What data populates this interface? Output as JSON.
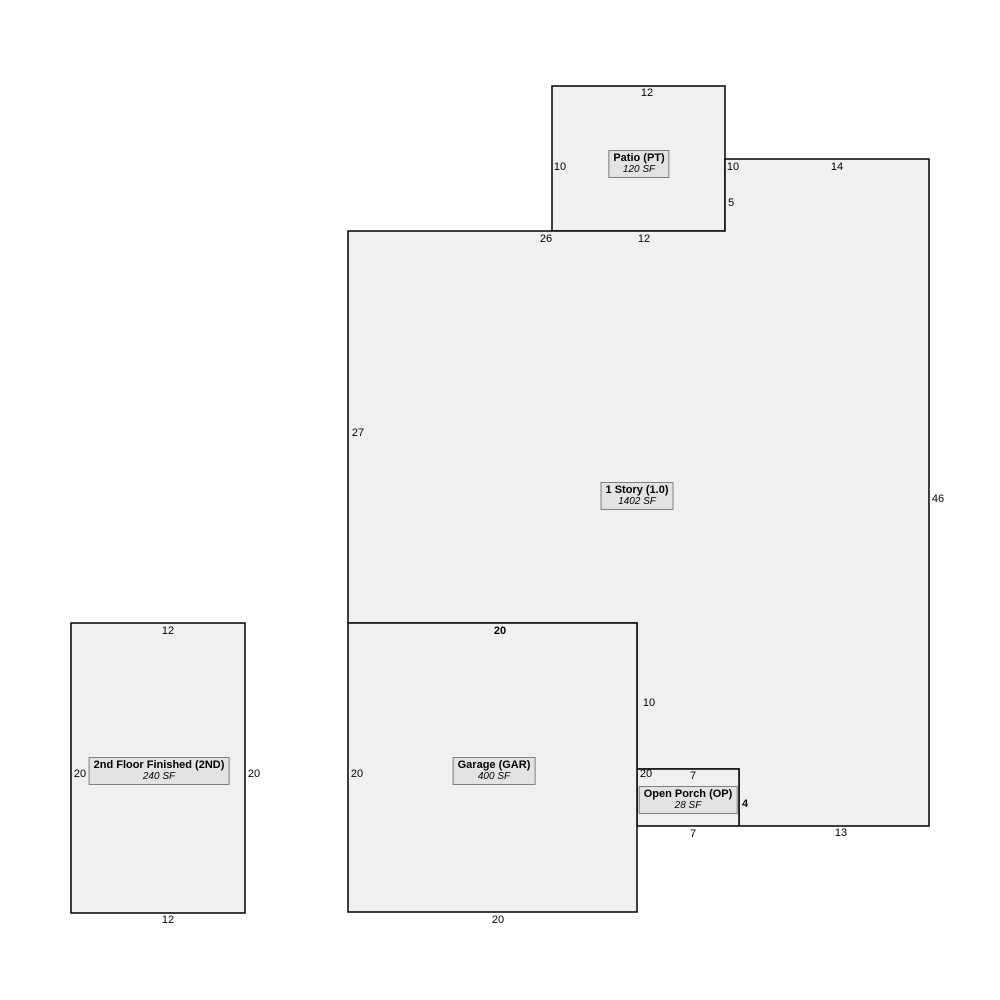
{
  "colors": {
    "shape_fill": "#f0f0f0",
    "label_fill": "#e3e3e3",
    "label_border": "#7f7f7f",
    "line": "#000000"
  },
  "areas": {
    "patio": {
      "title": "Patio (PT)",
      "area": "120 SF",
      "dims": {
        "top": "12",
        "left": "10",
        "right": "10",
        "bottom": "12"
      }
    },
    "one_story": {
      "title": "1 Story (1.0)",
      "area": "1402 SF",
      "dims": {
        "top": "26",
        "jog": "5",
        "top_right": "14",
        "right": "46",
        "left": "27",
        "side": "10",
        "bottom_right": "13"
      }
    },
    "garage": {
      "title": "Garage (GAR)",
      "area": "400 SF",
      "dims": {
        "top": "20",
        "left": "20",
        "right": "20",
        "bottom": "20"
      }
    },
    "open_porch": {
      "title": "Open Porch (OP)",
      "area": "28 SF",
      "dims": {
        "top": "7",
        "right": "4",
        "bottom": "7"
      }
    },
    "second_floor": {
      "title": "2nd Floor Finished (2ND)",
      "area": "240 SF",
      "dims": {
        "top": "12",
        "left": "20",
        "right": "20",
        "bottom": "12"
      }
    }
  }
}
